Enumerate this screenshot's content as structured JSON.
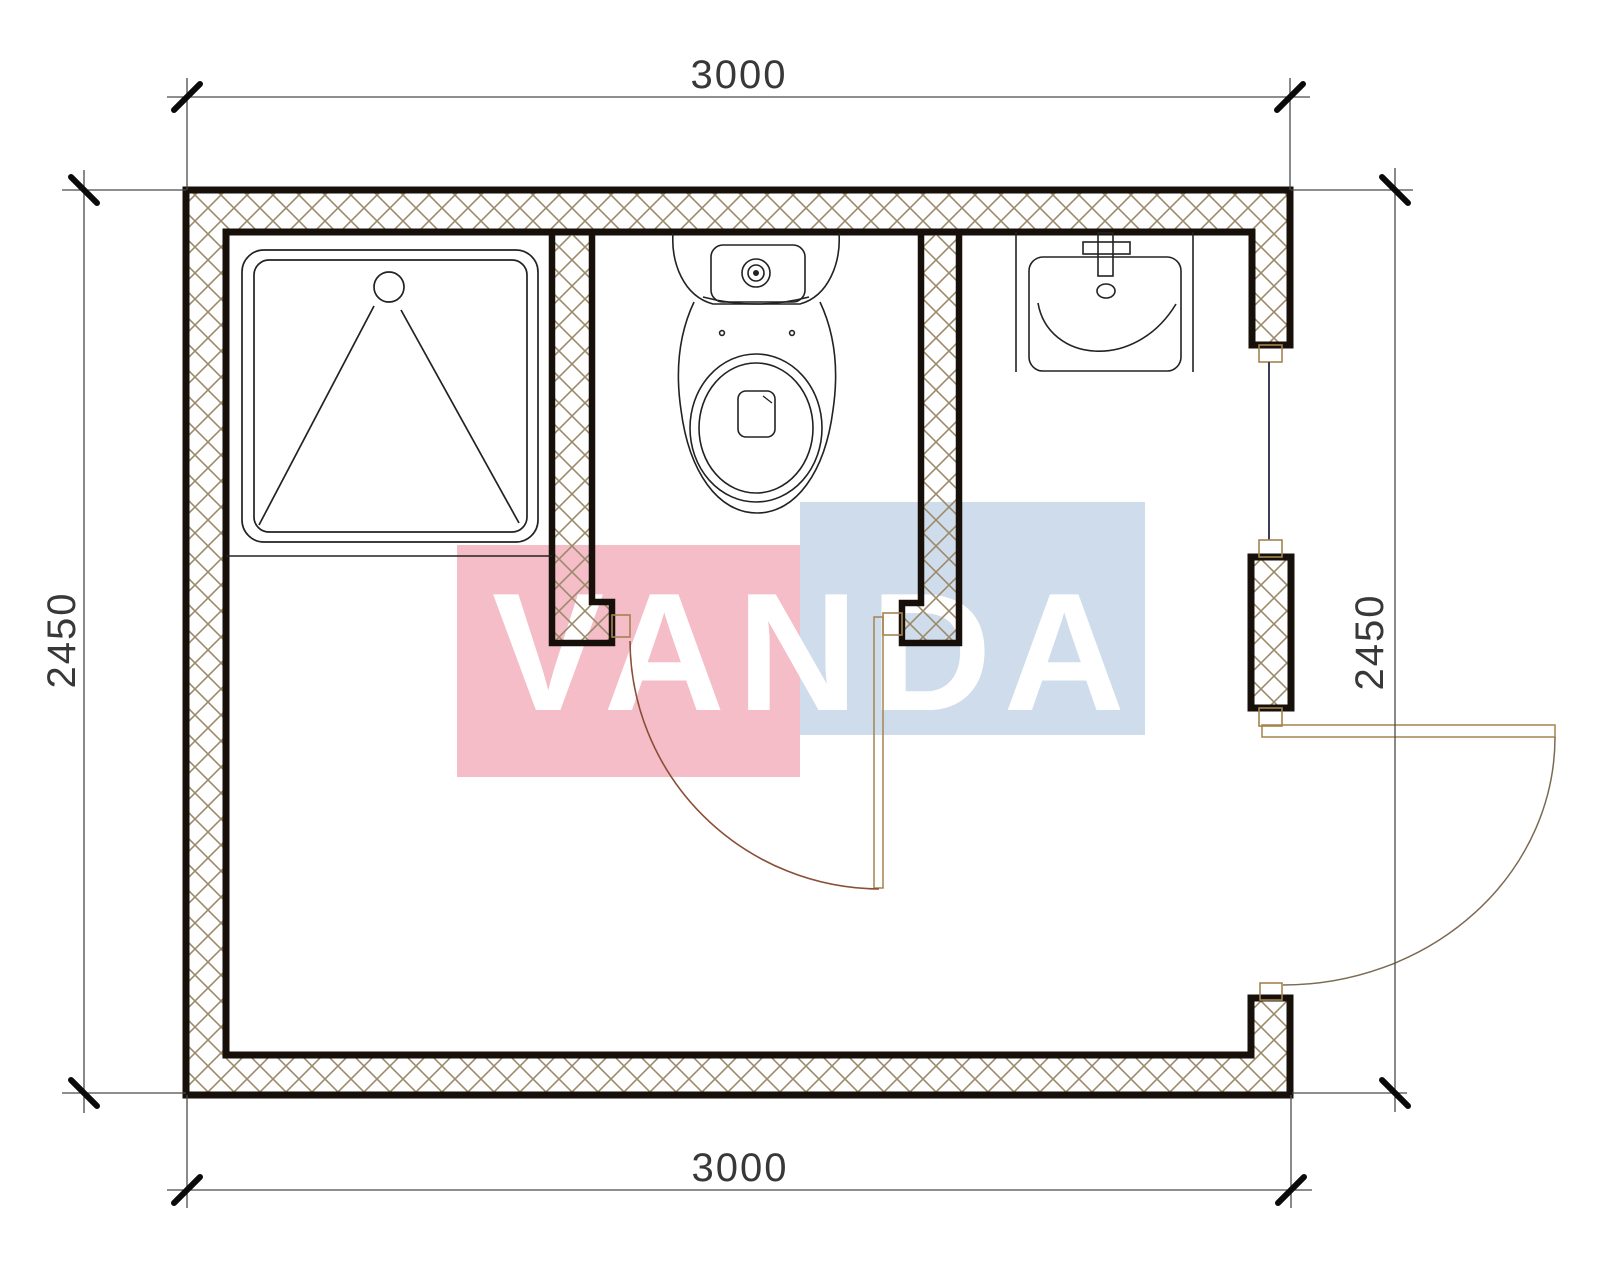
{
  "drawing": {
    "type": "floor-plan",
    "description_elements": {
      "shower": "shower-tray",
      "toilet": "toilet",
      "sink": "washbasin",
      "window": "window-right-wall",
      "interior_door": "interior-door-swing",
      "entrance_door": "entrance-door-swing"
    }
  },
  "dimensions": {
    "top": "3000",
    "bottom": "3000",
    "left": "2450",
    "right": "2450"
  },
  "watermark": {
    "text": "VANDA",
    "pink": "#f5bdc7",
    "blue": "#cfdceb",
    "letter_color": "#ffffff"
  },
  "colors": {
    "wall_outline": "#160f0a",
    "hatch": "#9b8a6b",
    "fixture_line": "#222222",
    "door_frame": "#a4834f",
    "interior_door_arc": "#8a4f36",
    "entrance_door_arc": "#7c6a52",
    "window_glass": "#3c3c5e",
    "dimension_line": "#4a4a4a",
    "dimension_tick": "#0a0a0a",
    "dimension_text": "#383838"
  }
}
